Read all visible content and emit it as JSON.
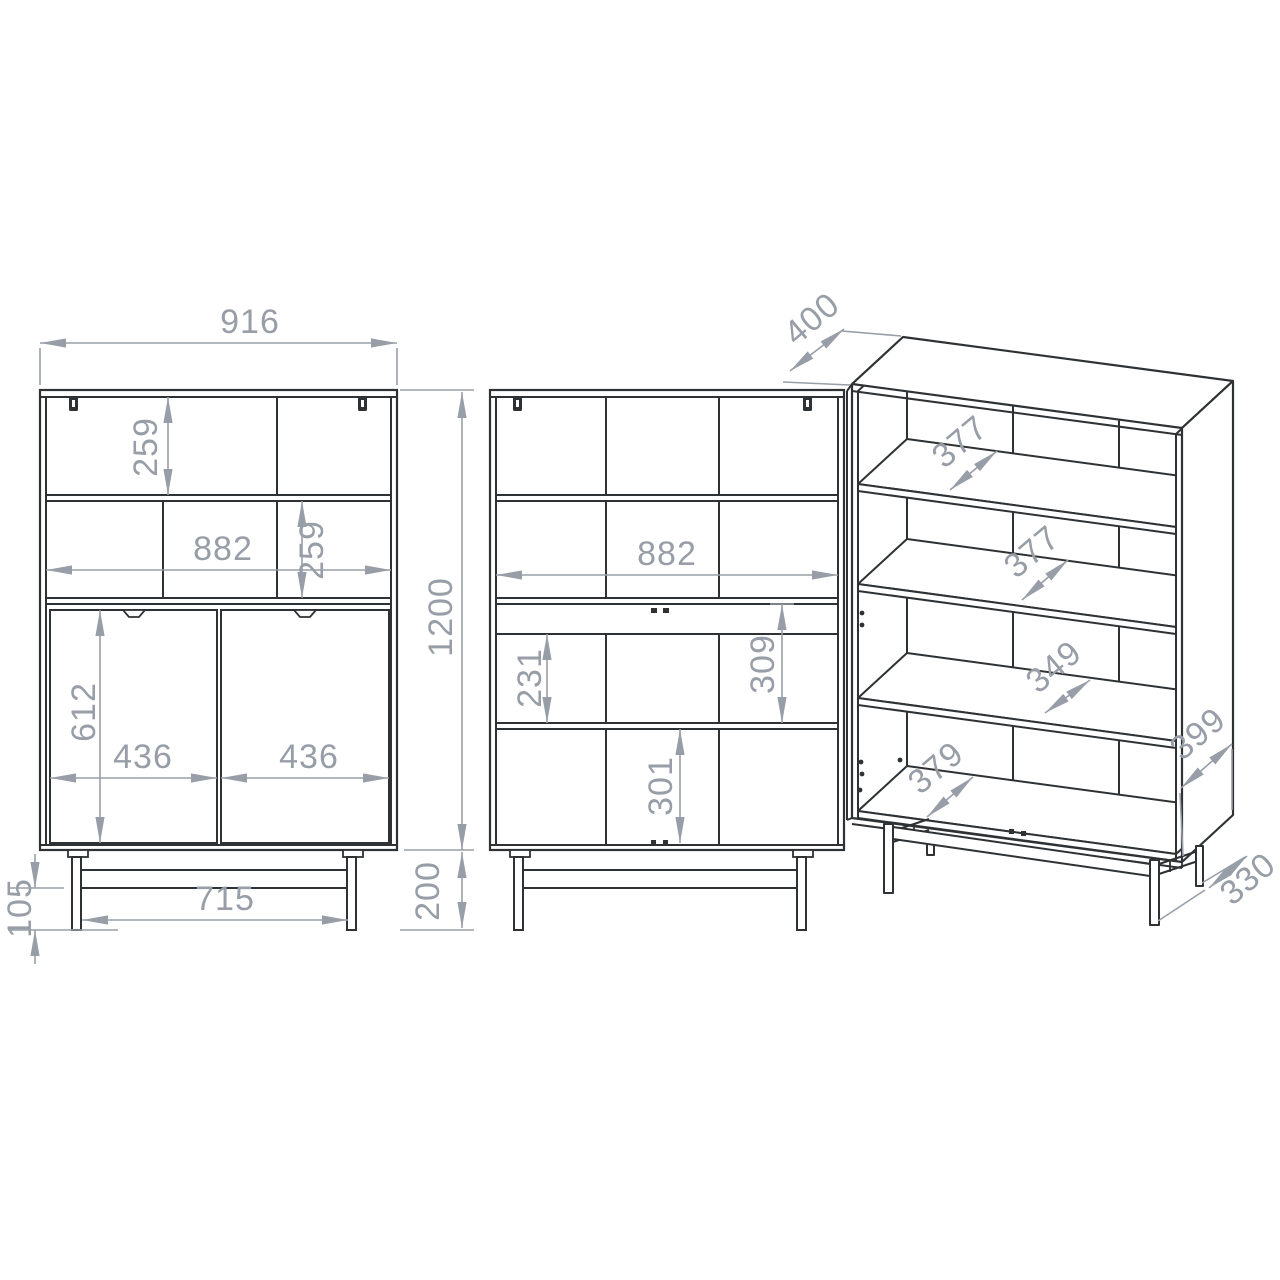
{
  "drawing": {
    "kind": "furniture-technical-drawing",
    "views": {
      "front": "front-view-with-doors",
      "open": "front-view-open",
      "iso": "isometric-view"
    }
  },
  "dims": {
    "front": {
      "overall_width": "916",
      "upper_opening_height": "259",
      "interior_width": "882",
      "middle_opening_height": "259",
      "door_height": "612",
      "left_door_width": "436",
      "right_door_width": "436",
      "underframe_clearance": "105",
      "leg_spacing": "715",
      "body_height": "1200",
      "base_height": "200"
    },
    "open": {
      "interior_width": "882",
      "shelf_opening_height": "231",
      "opening_with_rail_height": "309",
      "bottom_opening_height": "301"
    },
    "iso": {
      "depth": "400",
      "top_shelf_depth": "377",
      "middle_shelf_depth": "377",
      "lower_shelf_depth": "349",
      "bottom_panel_depth": "379",
      "side_panel_depth": "399",
      "base_frame_depth": "330"
    }
  },
  "icons": {
    "hinge": "hinge-bracket-icon",
    "handle": "door-handle-notch-icon",
    "pin": "shelf-pin-hole-icon"
  },
  "colors": {
    "line": "#2f3234",
    "dimension": "#989ea7",
    "background": "#ffffff"
  }
}
